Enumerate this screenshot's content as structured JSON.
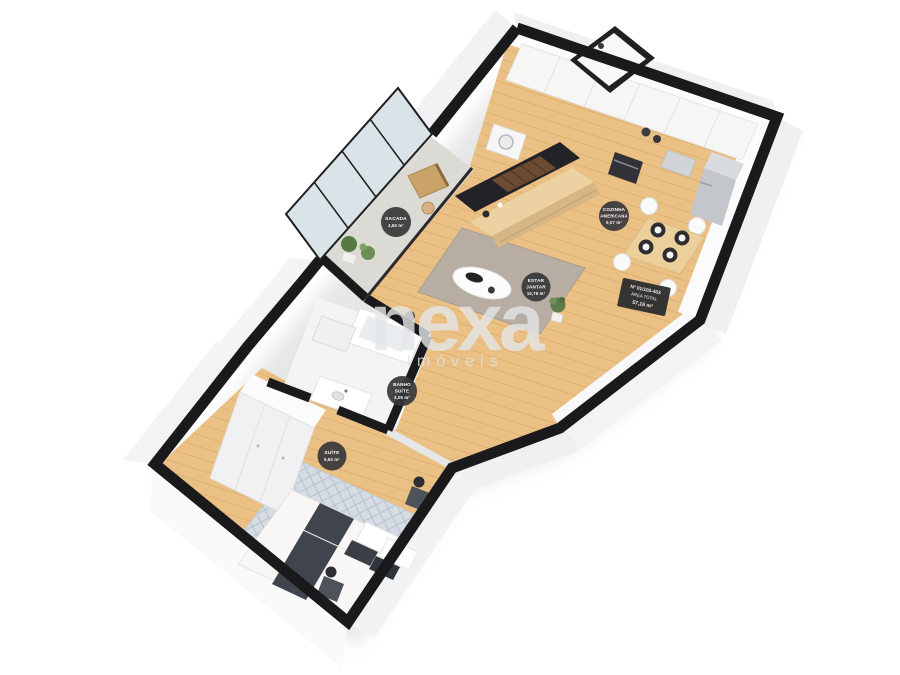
{
  "watermark": {
    "brand": "nexa",
    "subtitle": "Imóveis"
  },
  "floorplan": {
    "badges": [
      {
        "id": "sacada",
        "room": "balcony",
        "lines": [
          "SACADA",
          "4,60 m²"
        ]
      },
      {
        "id": "cozinha",
        "room": "kitchen",
        "lines": [
          "COZINHA",
          "AMERICANA",
          "9,07 m²"
        ]
      },
      {
        "id": "estar-jantar",
        "room": "living-dining",
        "lines": [
          "ESTAR",
          "JANTAR",
          "10,76 m²"
        ]
      },
      {
        "id": "banho",
        "room": "bathroom",
        "lines": [
          "BANHO",
          "SUÍTE",
          "4,05 m²"
        ]
      },
      {
        "id": "suite",
        "room": "bedroom",
        "lines": [
          "SUÍTE",
          "9,83 m²"
        ]
      }
    ],
    "unit_tag": {
      "lines": [
        "Nº 01/103-403",
        "ÁREA TOTAL",
        "57,16 m²"
      ]
    },
    "badge_style": {
      "fill": "#38383a",
      "text_color": "#ffffff"
    },
    "palette": {
      "wall_top": "#1a1a1c",
      "wall_face": "#f0f1f3",
      "wood_floor": "#eac084",
      "living_rug": "#b7ada2",
      "bedroom_rug": "#d7dde5",
      "balcony_floor": "#dcdad5",
      "bath_floor": "#f4f4f2",
      "glass": "#aec4cb",
      "tv_panel": "#232327",
      "wood_furniture": "#ecd2a2"
    }
  }
}
